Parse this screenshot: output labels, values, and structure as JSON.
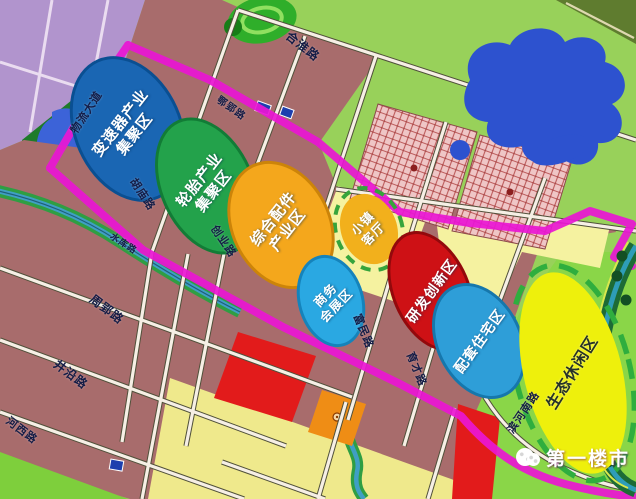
{
  "map": {
    "watermark": {
      "text": "第一楼市"
    },
    "boundary_color": "#ea16d4",
    "road_label_color": "#141c46",
    "zones": [
      {
        "id": "transmission",
        "label_lines": [
          "变速器产业",
          "集聚区"
        ],
        "fill": "#1a66b3",
        "border": "#0a4f92",
        "text_color": "#ffffff",
        "border_style": "solid"
      },
      {
        "id": "tire",
        "label_lines": [
          "轮胎产业",
          "集聚区"
        ],
        "fill": "#23a24b",
        "border": "#127c36",
        "text_color": "#ffffff",
        "border_style": "solid"
      },
      {
        "id": "parts",
        "label_lines": [
          "综合配件",
          "产业区"
        ],
        "fill": "#f4a71c",
        "border": "#cc8409",
        "text_color": "#ffffff",
        "border_style": "solid"
      },
      {
        "id": "town-hall",
        "label_lines": [
          "小镇",
          "客厅"
        ],
        "fill": "#f2b01c",
        "border": "#36a43c",
        "text_color": "#ffffff",
        "border_style": "dashed"
      },
      {
        "id": "business-expo",
        "label_lines": [
          "商务",
          "会展区"
        ],
        "fill": "#2aa8e2",
        "border": "#1583bb",
        "text_color": "#ffffff",
        "border_style": "solid"
      },
      {
        "id": "rnd-innovation",
        "label_lines": [
          "研发创新区"
        ],
        "fill": "#ce1115",
        "border": "#93090c",
        "text_color": "#ffffff",
        "border_style": "solid"
      },
      {
        "id": "residential",
        "label_lines": [
          "配套住宅区"
        ],
        "fill": "#2e9ed8",
        "border": "#1677ac",
        "text_color": "#ffffff",
        "border_style": "solid"
      },
      {
        "id": "eco-leisure",
        "label_lines": [
          "生态休闲区"
        ],
        "fill": "#eef00c",
        "border": "#2fae3e",
        "text_color": "#263228",
        "border_style": "dashed"
      }
    ],
    "roads": [
      {
        "id": "hehuai",
        "name": "合淮路"
      },
      {
        "id": "wuliu-dadao",
        "name": "物流大道"
      },
      {
        "id": "eying",
        "name": "鄂郢路"
      },
      {
        "id": "humiao",
        "name": "胡庙路"
      },
      {
        "id": "chuangye",
        "name": "创业路"
      },
      {
        "id": "shuiku",
        "name": "水库路"
      },
      {
        "id": "zhouying",
        "name": "周郢路"
      },
      {
        "id": "jingyan",
        "name": "井沿路"
      },
      {
        "id": "hexi",
        "name": "河西路"
      },
      {
        "id": "fumin",
        "name": "富民路"
      },
      {
        "id": "yucai",
        "name": "育才路"
      },
      {
        "id": "binhenan",
        "name": "滨河南路"
      }
    ]
  }
}
